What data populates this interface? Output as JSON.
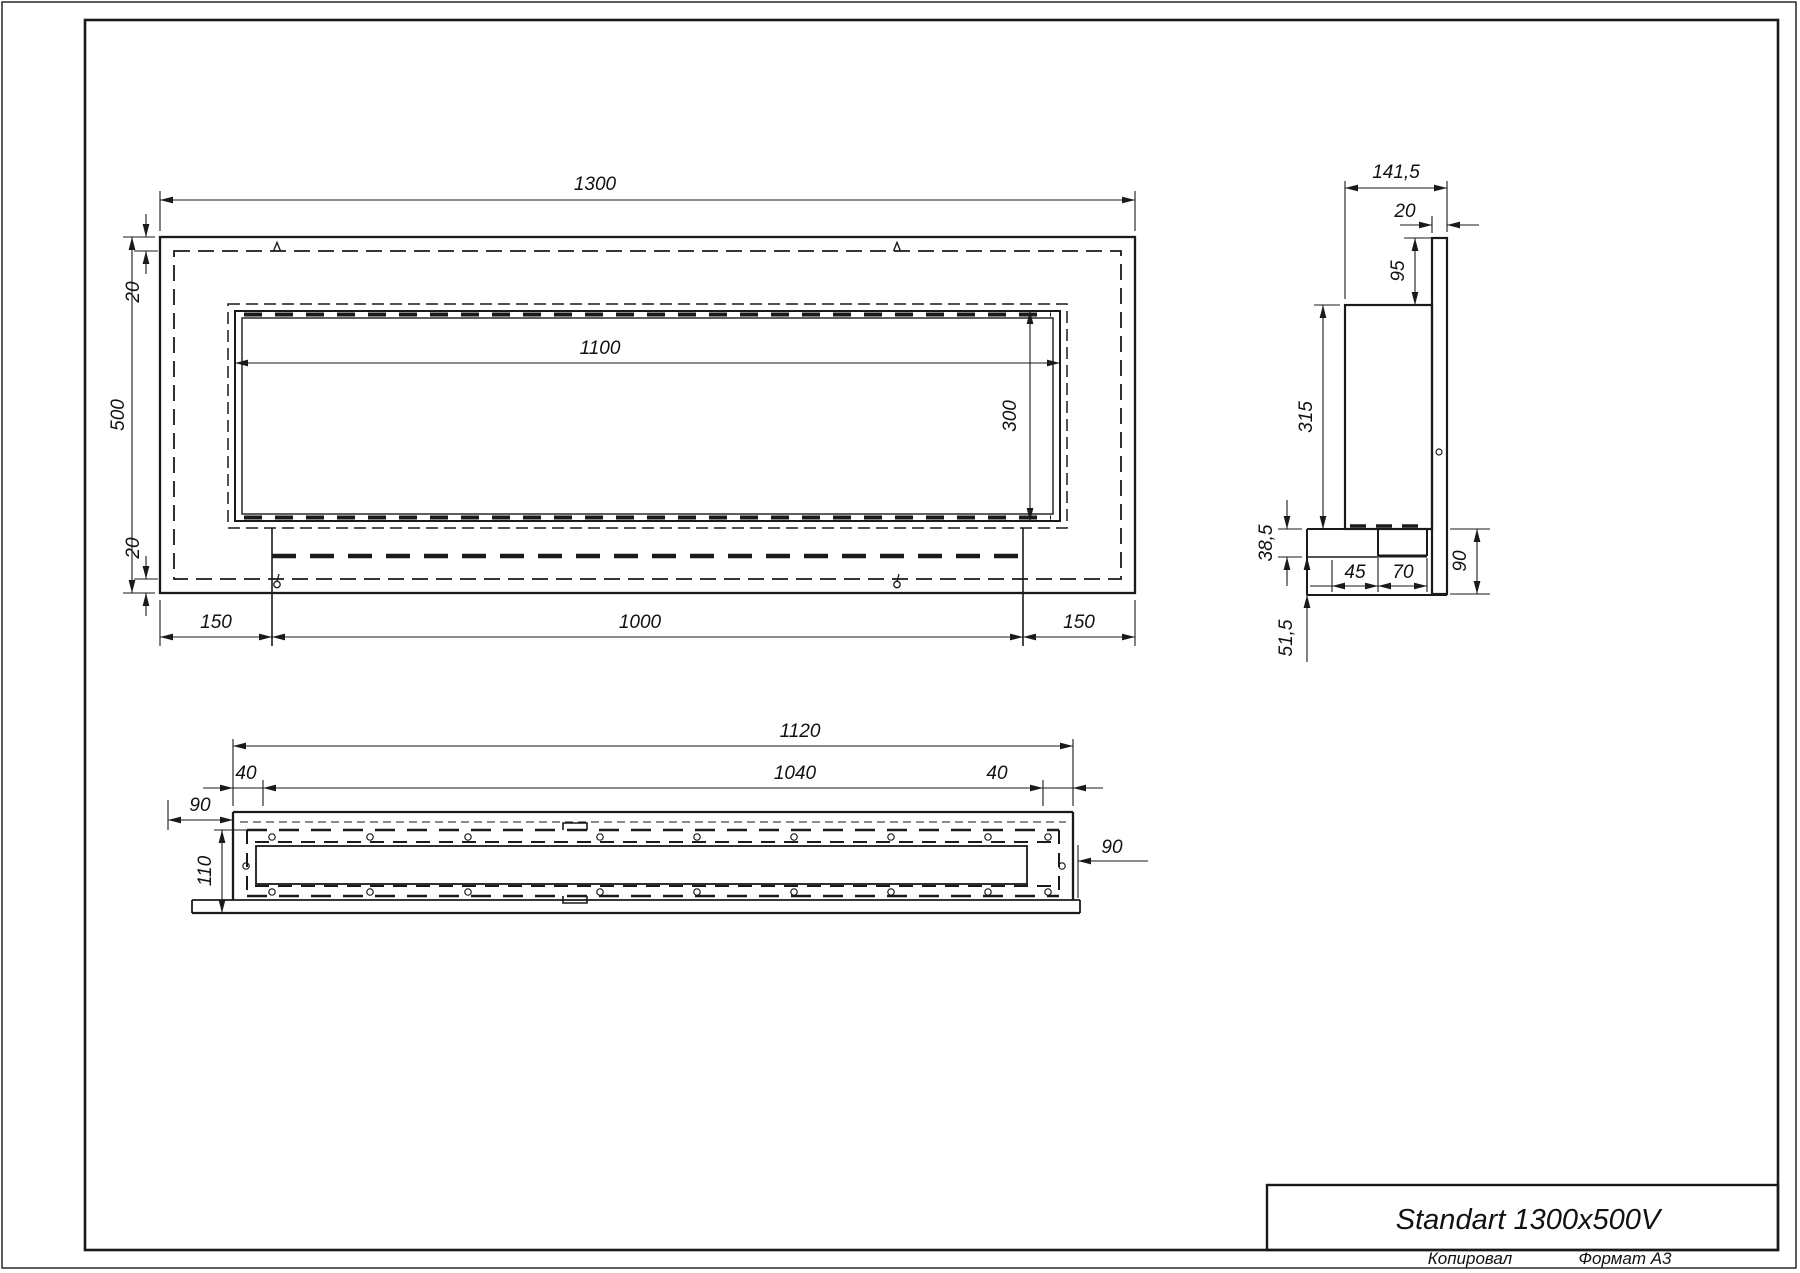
{
  "title_block": {
    "title": "Standart 1300x500V"
  },
  "footer": {
    "copied": "Копировал",
    "format": "Формат А3"
  },
  "views": {
    "front": {
      "dims": {
        "total_width": "1300",
        "total_height": "500",
        "offset_top": "20",
        "offset_bottom": "20",
        "opening_width": "1100",
        "opening_height": "300",
        "margin_left": "150",
        "center_span": "1000",
        "margin_right": "150"
      }
    },
    "side": {
      "dims": {
        "total_depth": "141,5",
        "flange_thickness": "20",
        "flange_top_height": "95",
        "body_height": "315",
        "shelf_thickness": "38,5",
        "notch_offset": "45",
        "notch_width": "70",
        "flange_bottom_height": "90",
        "bottom_drop": "51,5"
      }
    },
    "bottom": {
      "dims": {
        "plate_width": "1120",
        "inner_width": "1040",
        "inset_left": "40",
        "inset_right": "40",
        "offset_left": "90",
        "body_depth": "110",
        "offset_right": "90"
      }
    }
  }
}
